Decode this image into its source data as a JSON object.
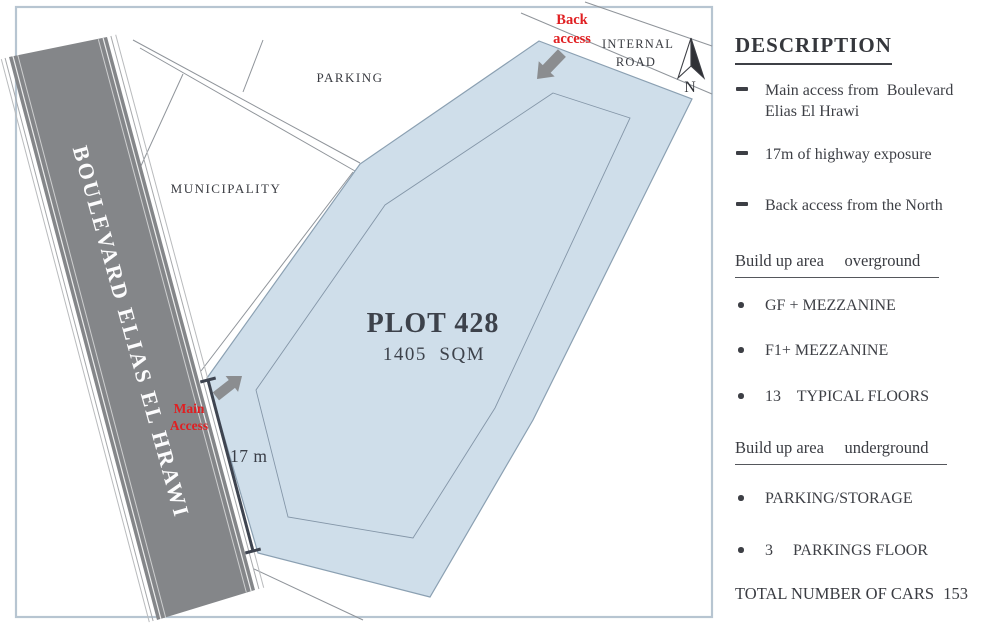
{
  "panel": {
    "title": "DESCRIPTION",
    "access_points": [
      {
        "text": "Main access from  Boulevard Elias El Hrawi"
      },
      {
        "text": "17m of highway exposure"
      },
      {
        "text": "Back access from the North"
      }
    ],
    "overground": {
      "heading": "Build up area     overground",
      "items": [
        {
          "text": "GF + MEZZANINE"
        },
        {
          "text": "F1+ MEZZANINE"
        },
        {
          "text": "13    TYPICAL FLOORS"
        }
      ]
    },
    "underground": {
      "heading": "Build up area     underground",
      "items": [
        {
          "text": "PARKING/STORAGE"
        },
        {
          "text": "3     PARKINGS FLOOR"
        }
      ]
    },
    "total": {
      "label": "TOTAL NUMBER OF CARS",
      "value": "153"
    }
  },
  "map": {
    "plot_label": "PLOT 428",
    "plot_area": "1405  SQM",
    "boulevard_label": "BOULEVARD ELIAS EL HRAWI",
    "labels": {
      "parking": "PARKING",
      "municipality": "MUNICIPALITY",
      "internal_road_1": "INTERNAL",
      "internal_road_2": "ROAD",
      "north": "N",
      "dimension": "17 m"
    },
    "access": {
      "back_1": "Back",
      "back_2": "access",
      "main_1": "Main",
      "main_2": "Access"
    },
    "colors": {
      "plot_fill": "#cfdeea",
      "plot_outline": "#8ba0b2",
      "road_fill": "#848689",
      "accent_red": "#e01f22",
      "frame": "#b7c5d1",
      "ink": "#3d3f45"
    }
  }
}
